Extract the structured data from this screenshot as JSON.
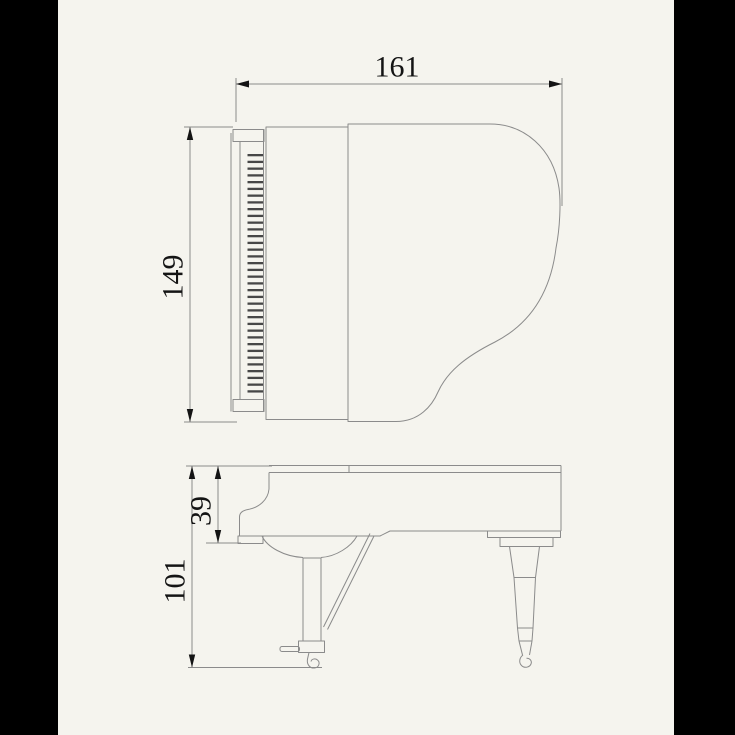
{
  "page": {
    "background": "#f5f4ee",
    "pillarbox_color": "#000000"
  },
  "drawing": {
    "subject": "Grand piano dimension diagram, top view and side view",
    "line_color": "#8b8b8b",
    "text_color": "#141414",
    "black_key_color": "#474747",
    "top_view": {
      "name": "top view",
      "black_key_count": 36
    },
    "side_view": {
      "name": "side view"
    },
    "dimensions": {
      "width": "161",
      "depth": "149",
      "case_height": "39",
      "total_height": "101"
    }
  }
}
